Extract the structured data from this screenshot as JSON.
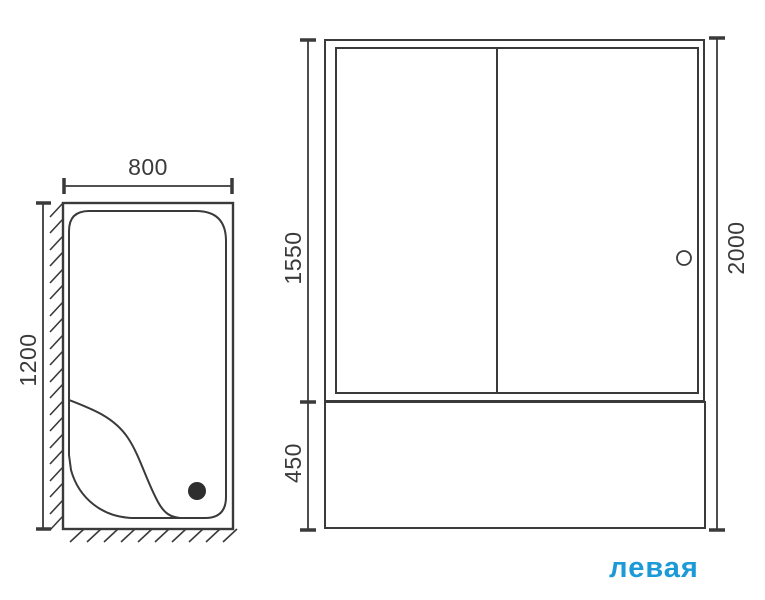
{
  "colors": {
    "line": "#3a3a3a",
    "accent": "#1b9ad7"
  },
  "top_view": {
    "description": "bathtub top view with wall hatching, seat curve and drain",
    "width_mm": "800",
    "depth_mm": "1200"
  },
  "front_view": {
    "description": "sliding glass screen over bath front panel",
    "screen_height_mm": "1550",
    "panel_height_mm": "450",
    "total_height_mm": "2000"
  },
  "orientation_label": "левая"
}
